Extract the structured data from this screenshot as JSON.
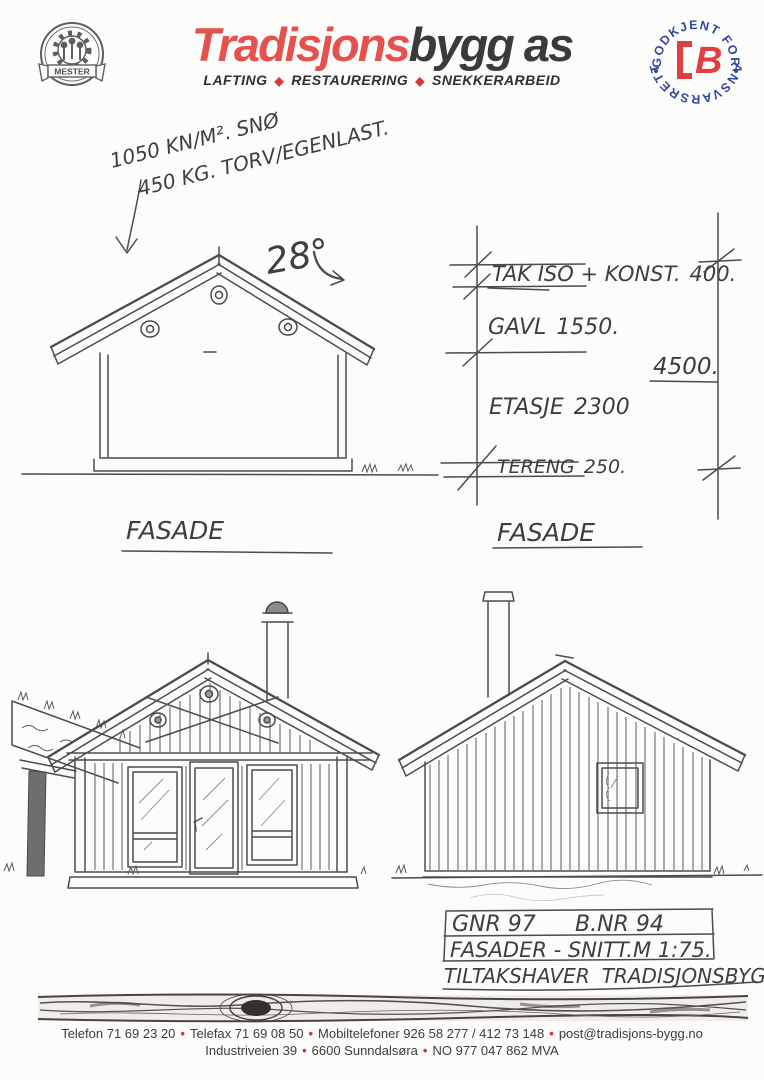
{
  "header": {
    "brand_red": "Tradisjons",
    "brand_dark": "bygg as",
    "tagline": [
      "LAFTING",
      "RESTAURERING",
      "SNEKKERARBEID"
    ],
    "tagline_sep": "◆",
    "seal": {
      "label": "MESTER"
    },
    "badge": {
      "arc_top": "GODKJENT FOR",
      "arc_bottom": "ANSVARSRETT",
      "letter": "B"
    },
    "colors": {
      "brand_red": "#E4514F",
      "brand_dark": "#3A3A3C",
      "badge_blue": "#3347A0",
      "badge_red": "#E23D3F",
      "bullet_red": "#CF3A35"
    }
  },
  "annotations": {
    "load_line1": "1050 KN/M². SNØ",
    "load_line2": "450 KG. TORV/EGENLAST.",
    "roof_angle": "28°",
    "label_fasade_left": "FASADE",
    "label_fasade_right": "FASADE"
  },
  "dimensions": {
    "items": [
      {
        "label": "TAK ISO + KONST.",
        "value": "400."
      },
      {
        "label": "GAVL",
        "value": "1550."
      },
      {
        "label": "ETASJE",
        "value": "2300"
      },
      {
        "label": "TERENG",
        "value": "250."
      }
    ],
    "total": "4500."
  },
  "title_block": {
    "gnr": "GNR 97",
    "bnr": "B.NR 94",
    "drawing": "FASADER - SNITT.",
    "scale": "M 1:75.",
    "owner_label": "TILTAKSHAVER",
    "owner": "TRADISJONSBYGG"
  },
  "footer": {
    "bullet": "•",
    "line1": [
      "Telefon 71 69 23 20",
      "Telefax 71 69 08 50",
      "Mobiltelefoner 926 58 277  /  412 73 148",
      "post@tradisjons-bygg.no"
    ],
    "line2": [
      "Industriveien 39",
      "6600 Sunndalsøra",
      "NO 977 047 862 MVA"
    ]
  }
}
